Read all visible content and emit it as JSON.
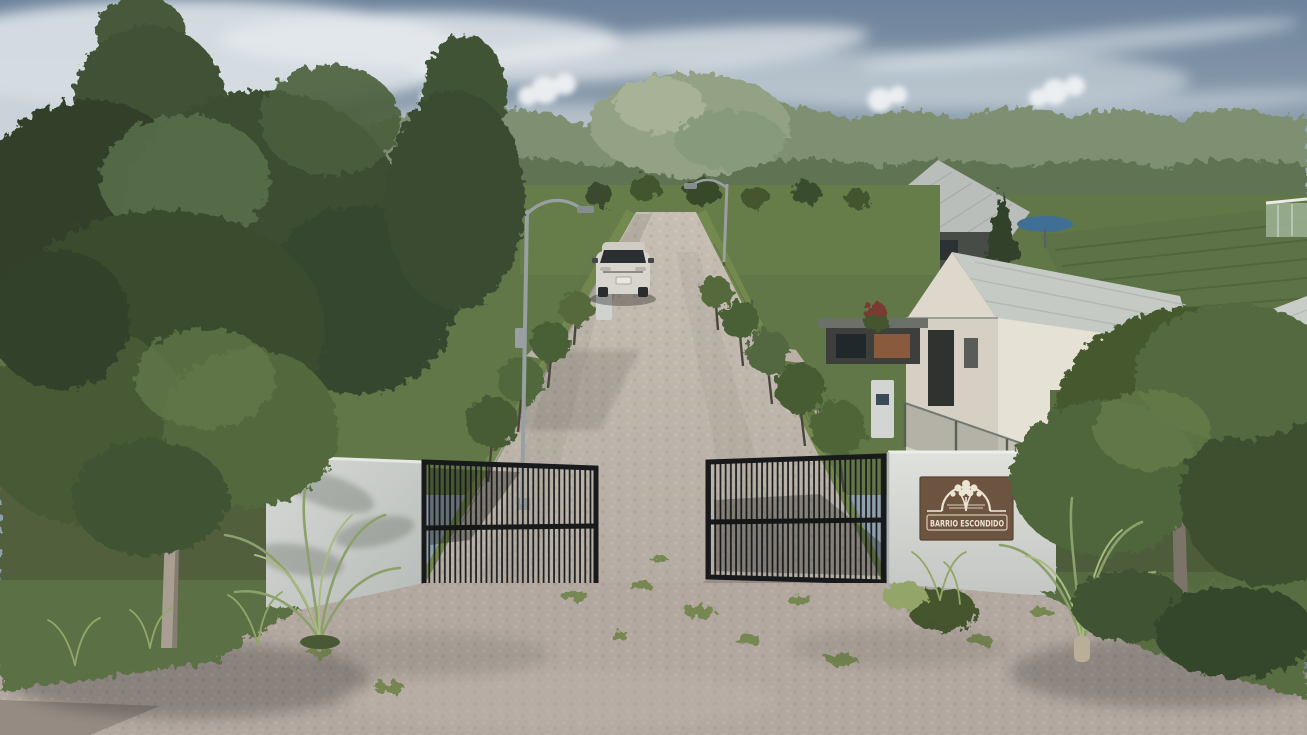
{
  "scene": {
    "setting": "daytime architectural rendering of a gated residential community entrance",
    "objects": [
      "sky with wispy and puffy clouds",
      "tree line on horizon",
      "modern white two-storey house on left behind trees",
      "barn-style houses with grey metal roofs on right",
      "crop field rows on far right",
      "paved cobblestone entry road",
      "white SUV approaching on road",
      "curved street lamps",
      "rows of young trees along road verges",
      "wire mesh fences and hedges",
      "two concrete entrance walls",
      "two black sliding metal gates standing open",
      "brown entrance sign with tree logo",
      "palm shrubs and ornamental grasses",
      "wide paver apron with grass patches in foreground",
      "large foreground trees left and right"
    ]
  },
  "sign": {
    "text": "BARRIO ESCONDIDO",
    "background_color": "#6d5440",
    "text_color": "#ece4d2",
    "logo": "tree-arch-icon"
  },
  "colors": {
    "sky_top": "#6d839b",
    "sky_horizon": "#bcc5c8",
    "cloud": "#eaeef1",
    "foliage_dark": "#2f3d28",
    "foliage_mid": "#49603a",
    "foliage_light": "#6c8352",
    "distant_trees": "#7e8f72",
    "grass": "#5d7244",
    "grass_sunlit": "#74894f",
    "hedge": "#4d5c3a",
    "road": "#beb5ab",
    "apron": "#b2a8a0",
    "concrete_wall": "#ccd0cc",
    "gate_metal": "#1b1d1f",
    "car_body": "#d8d5cf",
    "barn_wall": "#e2ddd0",
    "barn_roof": "#c3c7c1",
    "bark": "#a89f92"
  }
}
